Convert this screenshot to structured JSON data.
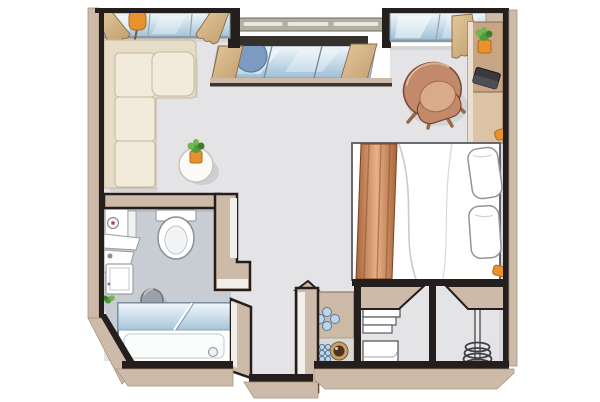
{
  "title": "studio hotel room floor plan (top-down illustration)",
  "colors": {
    "wall_dark": "#241f1c",
    "wall_top": "#cdbaa8",
    "wall_top_edge": "#a8947f",
    "wall_face": "#f1efeb",
    "floor_main": "#e4e3e6",
    "floor_bath": "#c7cdd3",
    "outline_soft": "#9aa0a6",
    "sofa_cream": "#f2ebdb",
    "sofa_back": "#e6dcc8",
    "sofa_line": "#c6b89d",
    "glass_light": "#eef6fa",
    "glass_mid": "#c3d9e7",
    "glass_deep": "#9dc0d6",
    "curtain_light": "#e3c89c",
    "curtain_dark": "#bf9c6d",
    "curtain_line": "#8a6a44",
    "railing": "#b2b0a2",
    "railing_slat": "#eae8dc",
    "parapet": "#35322e",
    "balcony_chair": "#7d9bc2",
    "accent_orange": "#e8912f",
    "plant_green": "#4e9c3c",
    "plant_green_light": "#74b453",
    "chair_brown": "#c28a6a",
    "chair_brown_deep": "#a06a4c",
    "chair_brown_light": "#d9ab8b",
    "leg_brown": "#9a6848",
    "desk_tan": "#c8a584",
    "desk_tan_light": "#dcc3a6",
    "laptop_dark": "#3a3a40",
    "runner_dark": "#a8643a",
    "runner_light": "#e6b287",
    "stool_gray": "#9ba1a6",
    "cups_blue": "#bcd6ec",
    "cups_blue_line": "#5a7a9a",
    "coffee_ring": "#c9a06a",
    "coffee_dark": "#4e3320"
  },
  "areas": [
    {
      "name": "living-area",
      "items": [
        "corner-sofa",
        "round-coffee-table",
        "potted-plant",
        "floor-lamp",
        "tub-armchair"
      ]
    },
    {
      "name": "balcony",
      "items": [
        "railing",
        "parapet",
        "window-front",
        "curtains",
        "round-lounge-chair"
      ]
    },
    {
      "name": "sleeping-area",
      "items": [
        "double-bed",
        "two-pillows",
        "bed-runner",
        "desk-wardrobe",
        "laptop",
        "desk-plant",
        "reading-lamp-head",
        "reading-lamp-foot"
      ]
    },
    {
      "name": "bathroom",
      "items": [
        "toilet",
        "water-heater",
        "washbasin-shelf",
        "vanity-cabinet",
        "round-stool",
        "bathtub",
        "shower-glass-screen",
        "small-plant",
        "drain"
      ]
    },
    {
      "name": "kitchenette",
      "items": [
        "counter",
        "four-glasses",
        "coffee-machine",
        "six-espresso-cups"
      ]
    },
    {
      "name": "entry",
      "items": [
        "linen-shelf-unit",
        "coat-rack-spiral"
      ]
    }
  ]
}
